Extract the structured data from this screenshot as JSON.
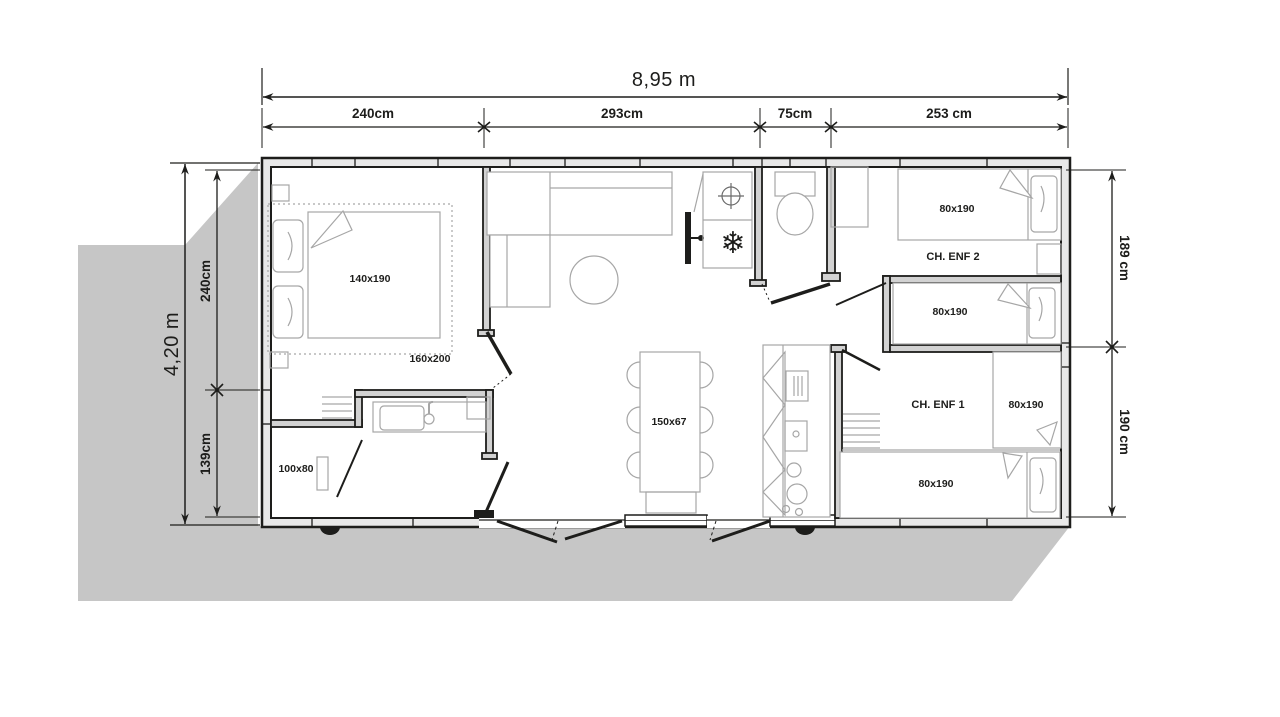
{
  "plan_type": "floor-plan",
  "dimensions": {
    "width_total": "8,95 m",
    "height_total": "4,20 m",
    "top": [
      "240cm",
      "293cm",
      "75cm",
      "253 cm"
    ],
    "left": [
      "240cm",
      "139cm"
    ],
    "right": [
      "189 cm",
      "190 cm"
    ]
  },
  "rooms": {
    "master": {
      "bed": "140x190",
      "bed_option": "160x200"
    },
    "bathroom": {
      "shower": "100x80"
    },
    "dining": {
      "table": "150x67"
    },
    "child2": {
      "name": "CH. ENF 2",
      "beds": [
        "80x190",
        "80x190"
      ]
    },
    "child1": {
      "name": "CH. ENF 1",
      "beds": [
        "80x190",
        "80x190"
      ]
    }
  },
  "icons": {
    "freezer_glyph": "❄"
  },
  "colors": {
    "shadow": "#c6c6c6",
    "wall_fill": "#e8e8e8",
    "interior_wall_fill": "#d2d2d2",
    "line": "#1d1d1b",
    "furniture_line": "#a6a6a6"
  }
}
